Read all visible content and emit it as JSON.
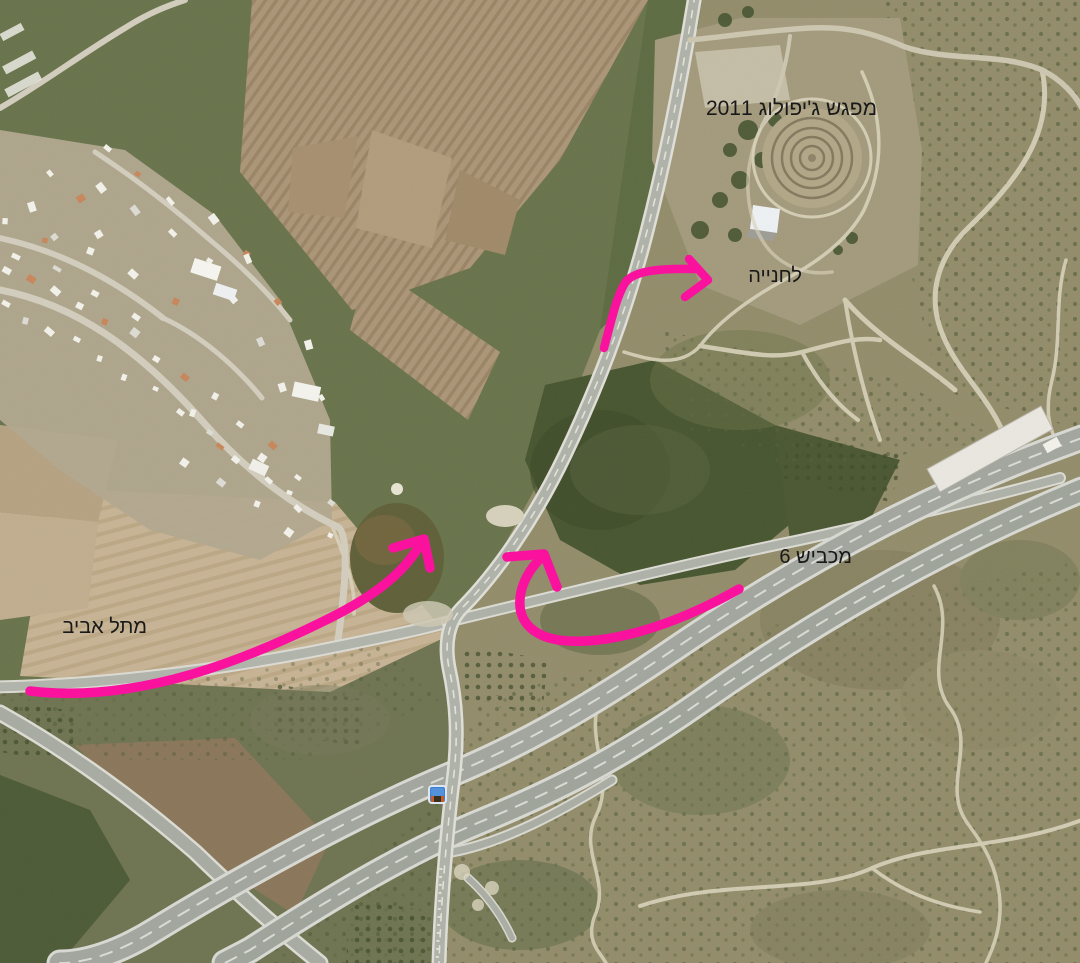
{
  "annotations": {
    "color": "#fa129e",
    "labels": {
      "meetup": "מפגש ג'יפולוג 2011",
      "parking": "לחנייה",
      "from_highway6": "מכביש 6",
      "from_tel_aviv": "מתל אביב"
    },
    "routes": [
      {
        "name": "route-from-tel-aviv"
      },
      {
        "name": "route-from-highway-6"
      },
      {
        "name": "route-to-parking"
      }
    ],
    "marker": "vehicle-marker"
  }
}
